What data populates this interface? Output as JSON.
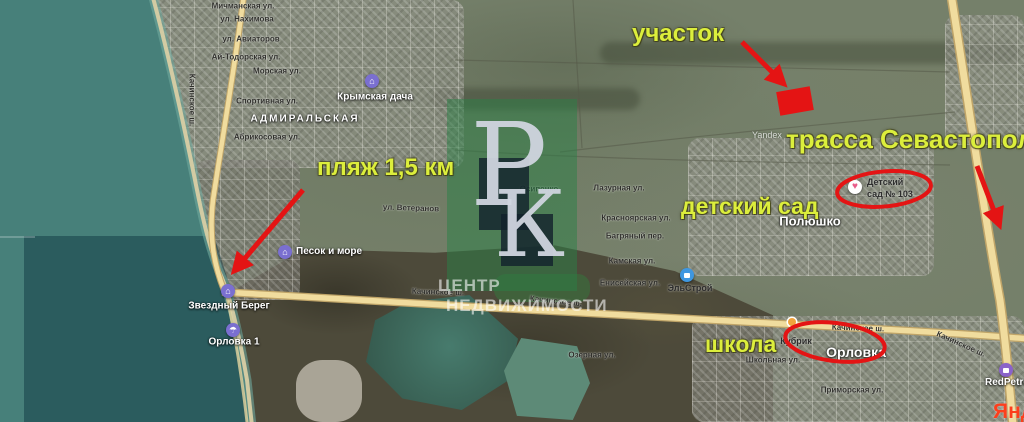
{
  "annotations": {
    "plot_label": "участок",
    "highway_label": "трасса Севастополь",
    "beach_label": "пляж 1,5 км",
    "kindergarten_label": "детский сад",
    "school_label": "школа",
    "text_color": "#dcee3c",
    "marker_color": "#e41414"
  },
  "brand_watermark": {
    "initial_top": "Р",
    "initial_bottom": "К",
    "caption_line1": "ЦЕНТР",
    "caption_line2": "НЕДВИЖИМОСТИ",
    "square_color": "#2a8046"
  },
  "imagery_watermarks": {
    "yandex_small": "Yandex",
    "yandex_logo_partial": "Янд"
  },
  "districts": [
    {
      "name": "АДМИРАЛЬСКАЯ"
    },
    {
      "name": "Полюшко"
    },
    {
      "name": "Орловка"
    }
  ],
  "pois": [
    {
      "label": "Крымская дача",
      "icon": "lodging"
    },
    {
      "label": "Песок и море",
      "icon": "lodging"
    },
    {
      "label": "Звездный Берег",
      "icon": "lodging"
    },
    {
      "label": "Орловка 1",
      "icon": "beach"
    },
    {
      "label": "ЭльСтрой",
      "icon": "store"
    },
    {
      "label_line1": "Детский",
      "label_line2": "сад № 103",
      "icon": "kindergarten"
    },
    {
      "label": "Кубрик",
      "icon": "cafe"
    },
    {
      "label": "RedPetro",
      "icon": "fuel-station"
    }
  ],
  "streets": [
    {
      "name": "Мичманская ул."
    },
    {
      "name": "ул. Нахимова"
    },
    {
      "name": "ул. Авиаторов"
    },
    {
      "name": "Ай-Тодорская ул."
    },
    {
      "name": "Морская ул."
    },
    {
      "name": "Спортивная ул."
    },
    {
      "name": "Абрикосовая ул."
    },
    {
      "name": "Качинское ш."
    },
    {
      "name": "ул. Ветеранов"
    },
    {
      "name": "Осипенко"
    },
    {
      "name": "Лазурная ул."
    },
    {
      "name": "Красноярская ул."
    },
    {
      "name": "Багряный пер."
    },
    {
      "name": "Камская ул."
    },
    {
      "name": "Енисейская ул."
    },
    {
      "name": "Качинское ш."
    },
    {
      "name": "Качинское ш."
    },
    {
      "name": "Озерная ул."
    },
    {
      "name": "Качинское ш."
    },
    {
      "name": "Качинское ш."
    },
    {
      "name": "Школьная ул."
    },
    {
      "name": "Приморская ул."
    }
  ],
  "road_colors": {
    "fill": "#f0dc9e",
    "casing": "#bfa468"
  },
  "sea_color": "#47807a"
}
